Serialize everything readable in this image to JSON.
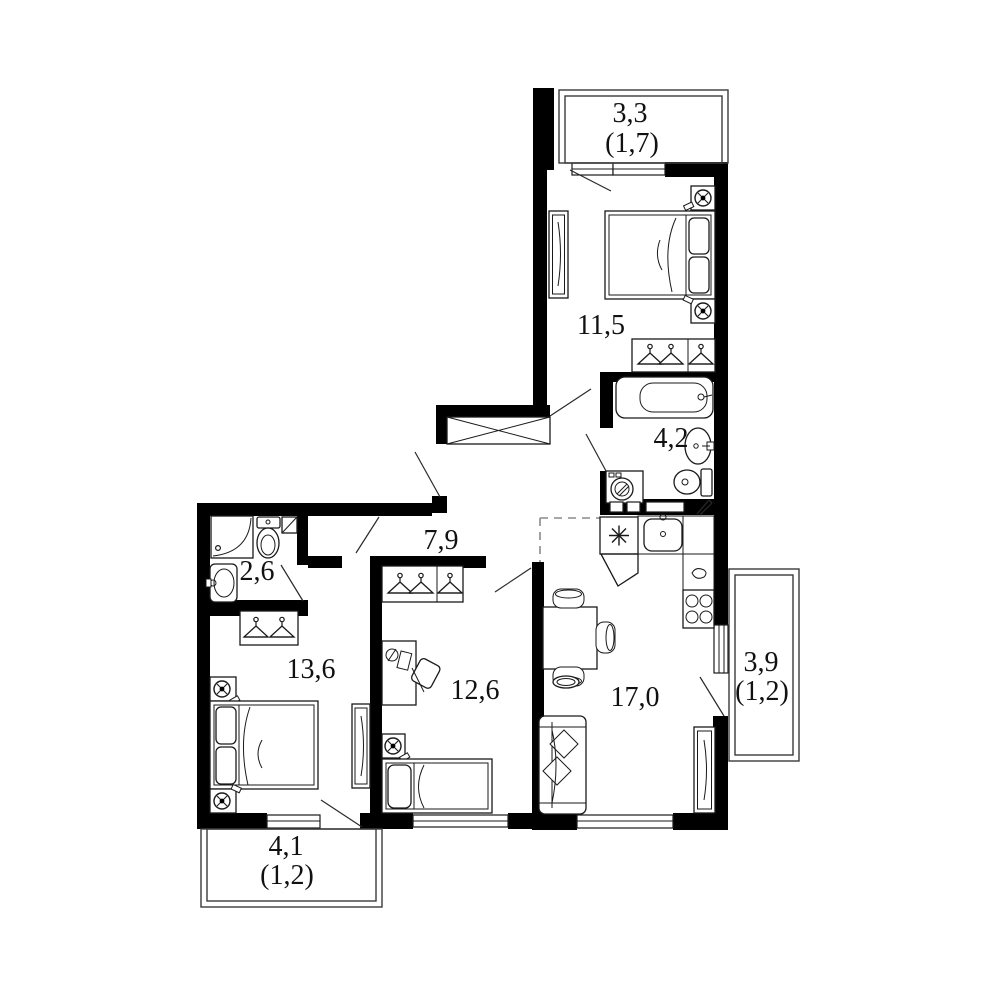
{
  "colors": {
    "wall": "#000000",
    "background": "#ffffff",
    "furniture_line": "#1a1a1a",
    "label_text": "#111111"
  },
  "rooms": {
    "bedroom_top": {
      "area": "11,5"
    },
    "bathroom_main": {
      "area": "4,2"
    },
    "hallway": {
      "area": "7,9"
    },
    "bathroom_small": {
      "area": "2,6"
    },
    "bedroom_left": {
      "area": "13,6"
    },
    "room_middle": {
      "area": "12,6"
    },
    "kitchen_living": {
      "area": "17,0"
    },
    "balcony_top": {
      "area": "3,3",
      "reduced_area": "(1,7)"
    },
    "balcony_right": {
      "area": "3,9",
      "reduced_area": "(1,2)"
    },
    "balcony_bottom": {
      "area": "4,1",
      "reduced_area": "(1,2)"
    }
  },
  "icons": [
    "double-bed",
    "single-bed",
    "nightstand-lamp",
    "wardrobe-hangers",
    "tall-wardrobe",
    "built-in-closet",
    "bathtub",
    "shower-cabin",
    "toilet",
    "wash-basin",
    "washing-machine",
    "fridge",
    "kitchen-sink",
    "stove",
    "dining-table",
    "chair",
    "sofa",
    "desk",
    "desk-chair",
    "side-table",
    "door-swing",
    "window"
  ]
}
